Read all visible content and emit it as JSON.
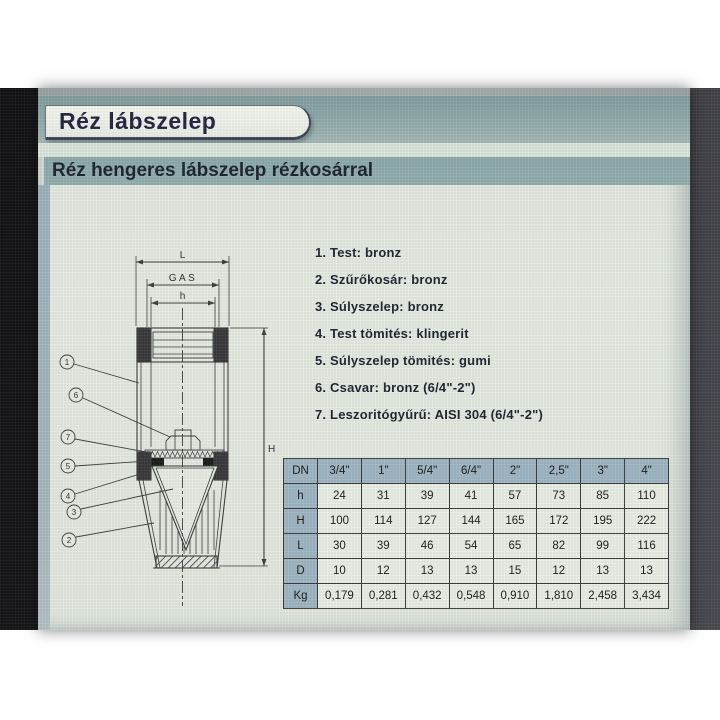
{
  "colors": {
    "band_teal": "#8fa9aa",
    "subtitle_band": "#95afb0",
    "page_bg": "#e6ece3",
    "margin_strip": "#a7b8c0",
    "table_header_bg": "#a0b7c4",
    "table_cell_bg": "#ebf0e6",
    "title_text": "#23253f",
    "body_text": "#1d2430"
  },
  "header": {
    "title": "Réz lábszelep",
    "subtitle": "Réz hengeres lábszelep rézkosárral"
  },
  "materials": {
    "items": [
      "1. Test: bronz",
      "2. Szűrőkosár: bronz",
      "3. Súlyszelep: bronz",
      "4. Test tömités: klingerit",
      "5. Súlyszelep tömités: gumi",
      "6. Csavar: bronz (6/4\"-2\")",
      "7. Leszoritógyűrű: AISI 304 (6/4\"-2\")"
    ]
  },
  "drawing": {
    "dim_labels": {
      "length": "L",
      "thread": "GAS",
      "height_small": "h",
      "height_total": "H"
    },
    "callouts": [
      "1",
      "6",
      "7",
      "5",
      "4",
      "3",
      "2"
    ]
  },
  "table": {
    "header": [
      "DN",
      "3/4\"",
      "1\"",
      "5/4\"",
      "6/4\"",
      "2\"",
      "2,5\"",
      "3\"",
      "4\""
    ],
    "rows": [
      {
        "label": "h",
        "values": [
          "24",
          "31",
          "39",
          "41",
          "57",
          "73",
          "85",
          "110"
        ]
      },
      {
        "label": "H",
        "values": [
          "100",
          "114",
          "127",
          "144",
          "165",
          "172",
          "195",
          "222"
        ]
      },
      {
        "label": "L",
        "values": [
          "30",
          "39",
          "46",
          "54",
          "65",
          "82",
          "99",
          "116"
        ]
      },
      {
        "label": "D",
        "values": [
          "10",
          "12",
          "13",
          "13",
          "15",
          "12",
          "13",
          "13"
        ]
      },
      {
        "label": "Kg",
        "values": [
          "0,179",
          "0,281",
          "0,432",
          "0,548",
          "0,910",
          "1,810",
          "2,458",
          "3,434"
        ]
      }
    ]
  }
}
